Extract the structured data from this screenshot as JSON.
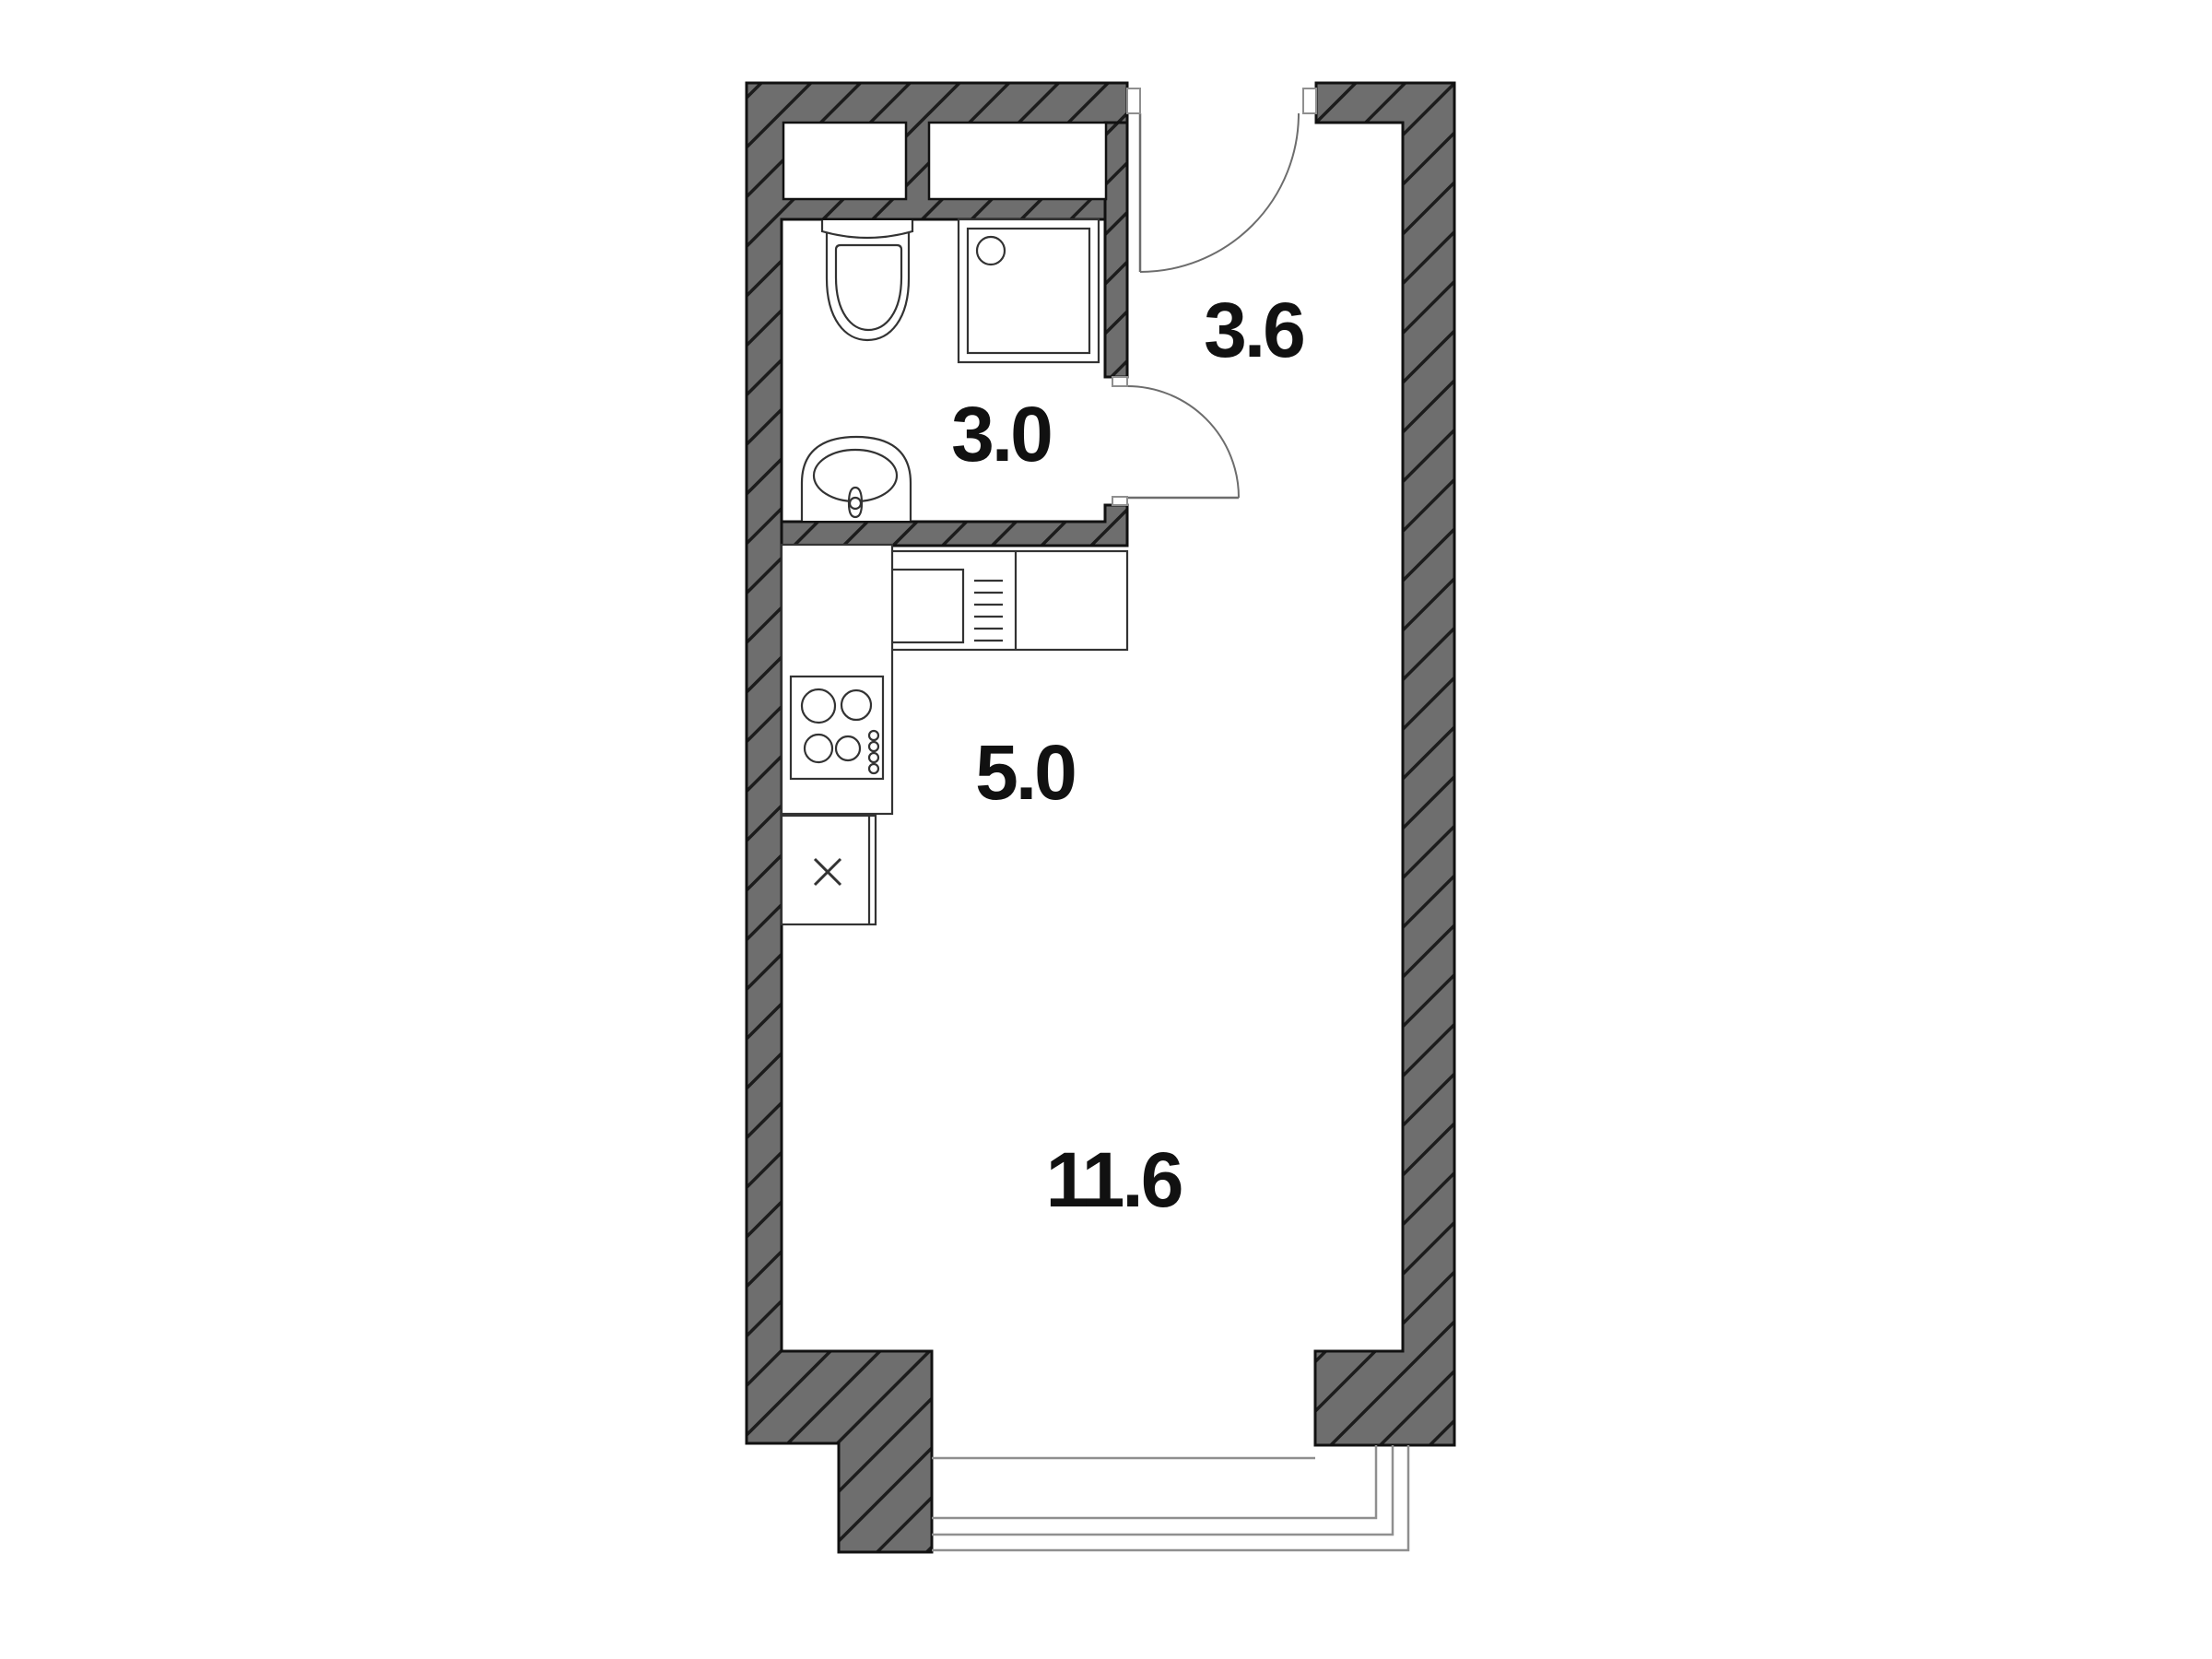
{
  "plan": {
    "title": "studio-apartment-floor-plan",
    "rooms": [
      {
        "id": "bathroom",
        "area": "3.0"
      },
      {
        "id": "hallway",
        "area": "3.6"
      },
      {
        "id": "kitchen",
        "area": "5.0"
      },
      {
        "id": "living-room",
        "area": "11.6"
      }
    ],
    "fixtures": [
      "toilet",
      "bathroom-sink",
      "shower",
      "wall-niche-left",
      "wall-niche-right",
      "kitchen-counter",
      "kitchen-appliance",
      "stove",
      "base-cabinet",
      "entrance-door",
      "bathroom-door",
      "window"
    ],
    "colors": {
      "background": "#ffffff",
      "wall_fill": "#6e6e6e",
      "wall_hatch": "#1c1c1c",
      "wall_outline": "#111111",
      "fixture_line": "#333333",
      "thin_line": "#8f8f8f",
      "label": "#111111"
    }
  }
}
